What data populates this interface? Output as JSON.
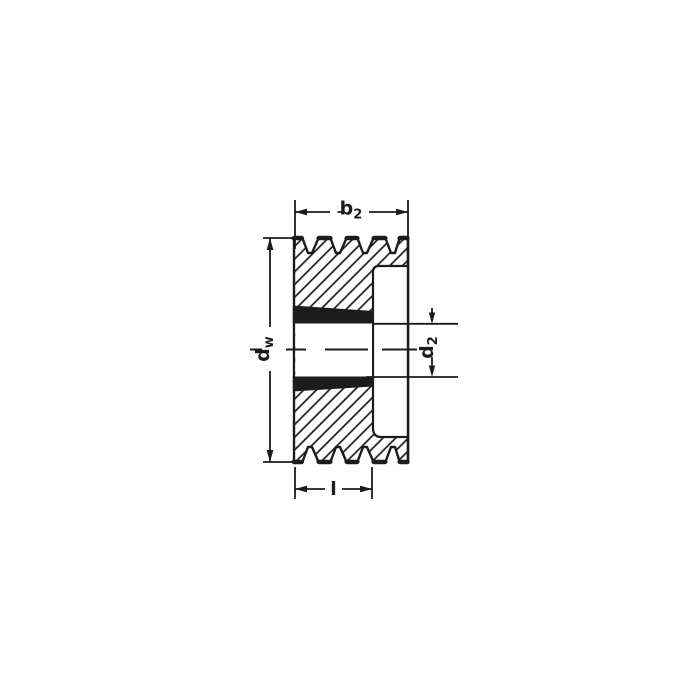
{
  "colors": {
    "ink": "#1c1c1c",
    "bg": "#ffffff"
  },
  "labels": {
    "b2": {
      "base": "b",
      "sub": "2"
    },
    "dw": {
      "base": "d",
      "sub": "w"
    },
    "d2": {
      "base": "d",
      "sub": "2"
    },
    "l": {
      "base": "l",
      "sub": ""
    }
  }
}
